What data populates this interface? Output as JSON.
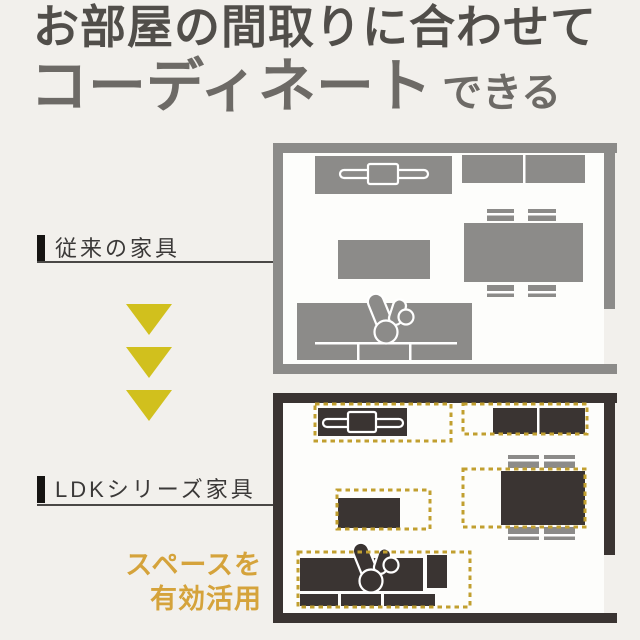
{
  "colors": {
    "background": "#f2f0ec",
    "heading_primary": "#514e4a",
    "heading_secondary": "#6d6a66",
    "label_text": "#3b3938",
    "label_bar": "#161412",
    "rule": "#4a4846",
    "plan_gray": "#8c8b89",
    "plan_dark": "#3a3432",
    "plan_interior": "#fdfdfb",
    "chair_gray": "#8c8b89",
    "arrow_yellow": "#d1c01d",
    "gold_text": "#d5a33b",
    "gold_dash": "#c19f2f"
  },
  "heading": {
    "line1": "お部屋の間取りに合わせて",
    "line2_large": "コーディネート",
    "line2_small": "できる"
  },
  "before_section": {
    "label": "従来の家具",
    "furniture_icons": [
      "tv-board-icon",
      "cabinet-icon",
      "coffee-table-icon",
      "dining-table-icon",
      "dining-chair-icon",
      "sofa-icon",
      "seated-person-icon"
    ]
  },
  "after_section": {
    "label": "LDKシリーズ家具",
    "caption_line1": "スペースを",
    "caption_line2": "有効活用",
    "furniture_icons": [
      "tv-board-icon",
      "cabinet-icon",
      "coffee-table-icon",
      "dining-table-icon",
      "dining-chair-icon",
      "sofa-icon",
      "side-table-icon",
      "seated-person-icon"
    ]
  },
  "icons": {
    "transition_arrow": "triangle-down",
    "person": "seated-person-top-view",
    "tv": "tv-on-board-top-view"
  }
}
